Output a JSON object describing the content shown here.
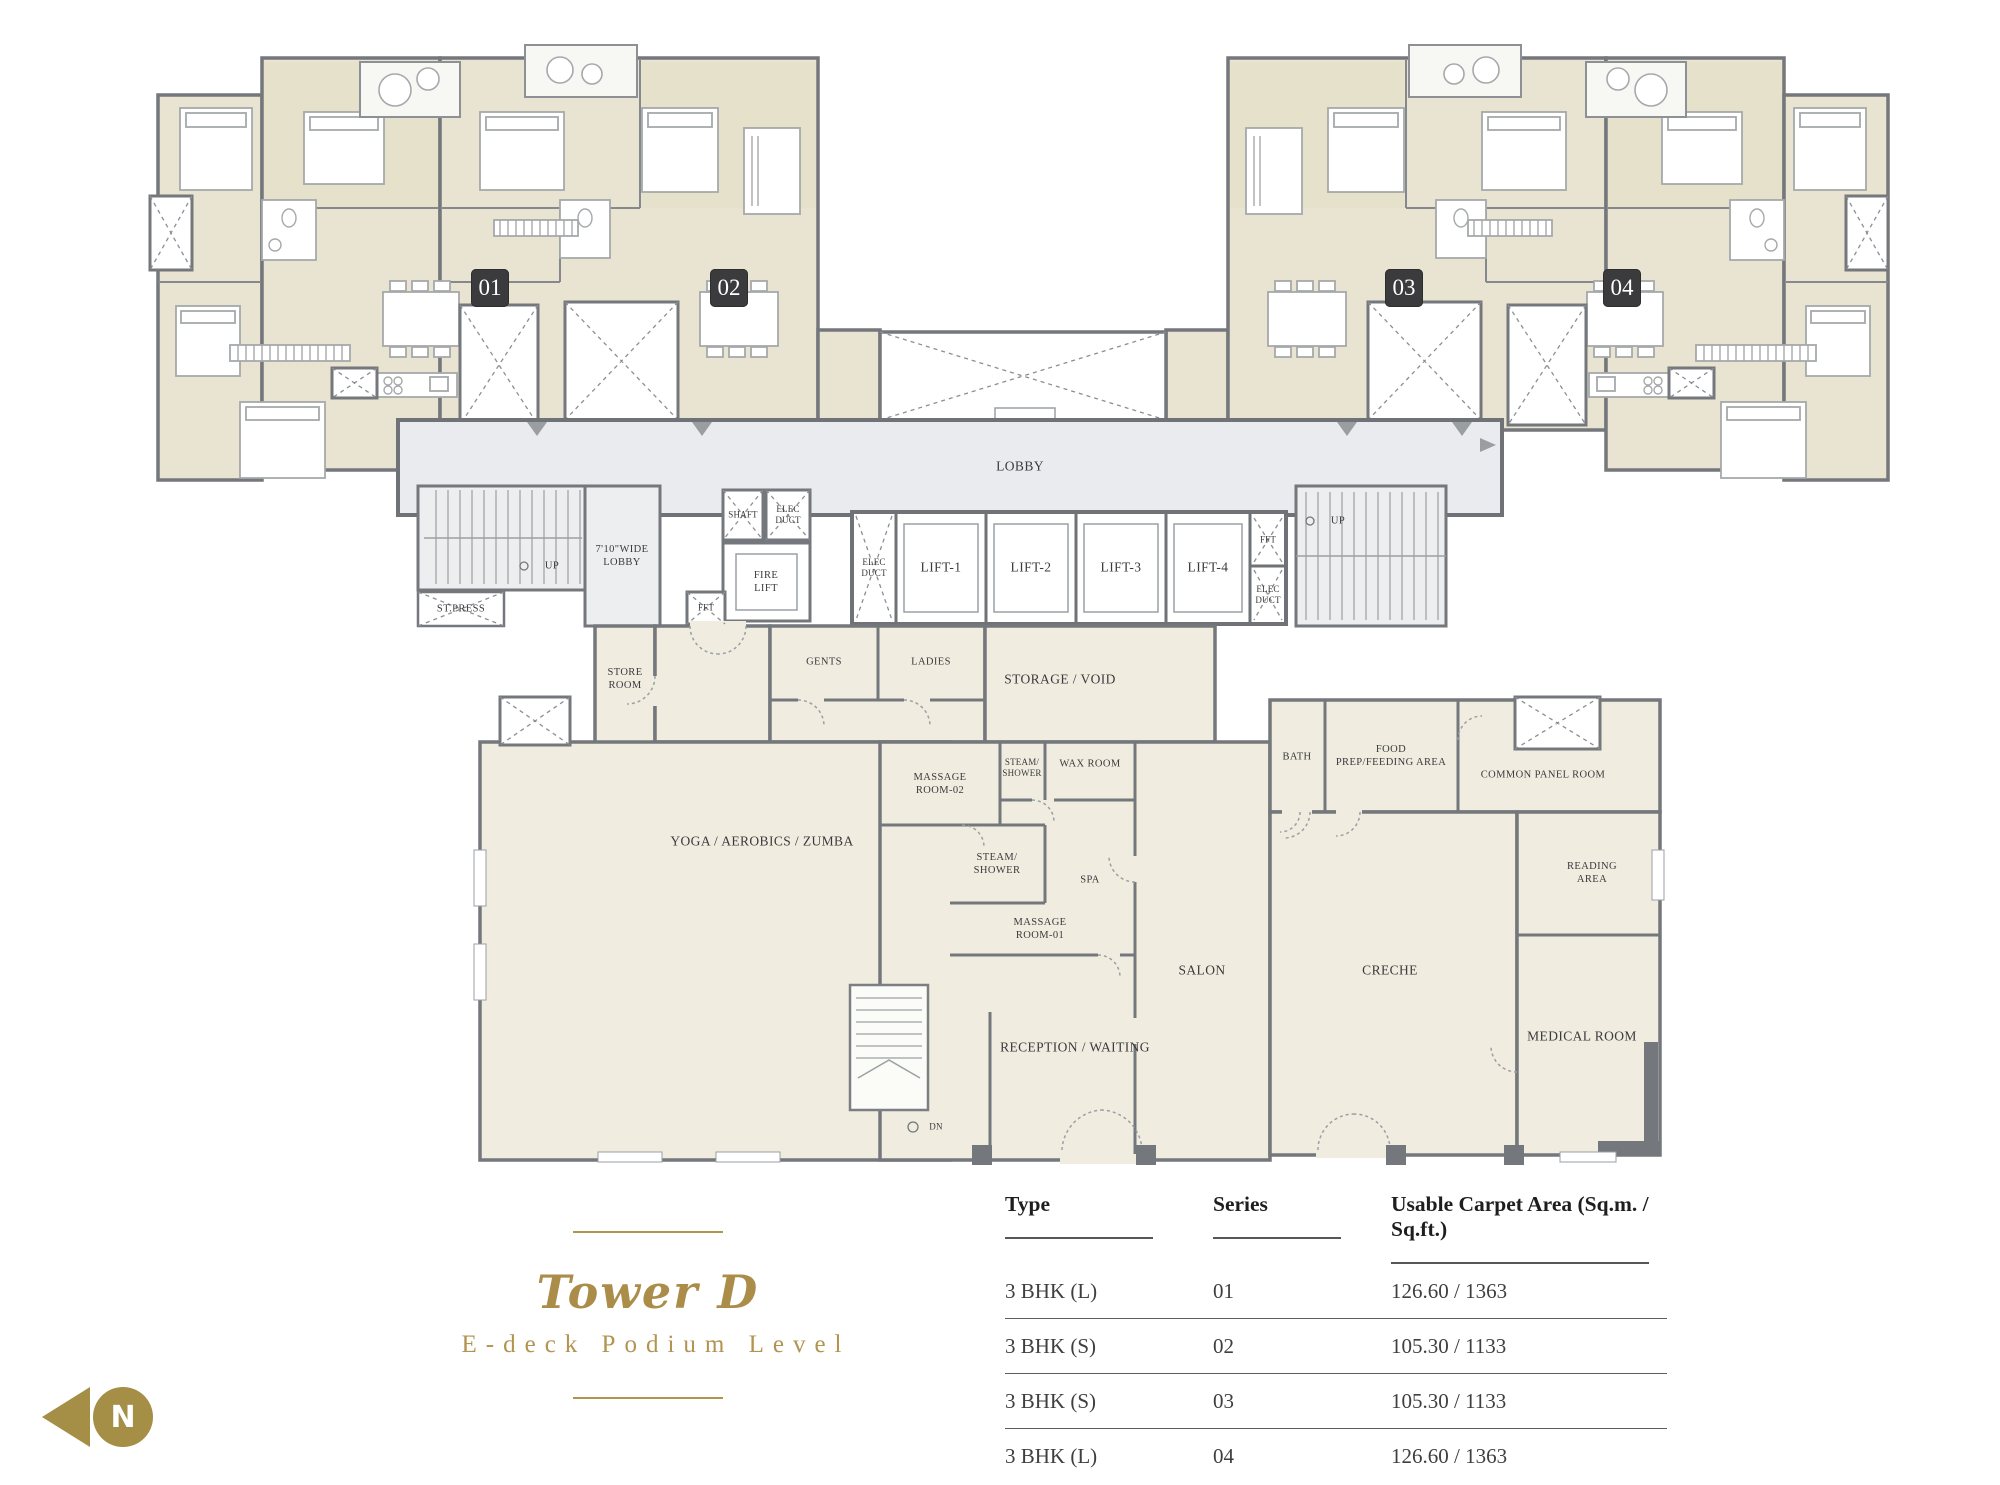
{
  "colors": {
    "accent_gold": "#ab8c49",
    "wall_gray": "#74777b",
    "apartment_fill": "#e9e4d1",
    "amenity_fill": "#f0ece0",
    "lobby_fill": "#e9ebee",
    "unit_badge_bg": "#3b3b3d"
  },
  "title": {
    "name": "Tower D",
    "subtitle": "E-deck Podium Level"
  },
  "north_label": "N",
  "units": [
    "01",
    "02",
    "03",
    "04"
  ],
  "core": {
    "lobby": "LOBBY",
    "up": "UP",
    "dn": "DN",
    "wide_lobby": {
      "l1": "7'10\"WIDE",
      "l2": "LOBBY"
    },
    "st_press": "ST.PRESS",
    "shaft": "SHAFT",
    "elec_duct": {
      "l1": "ELEC",
      "l2": "DUCT"
    },
    "fire_lift": {
      "l1": "FIRE",
      "l2": "LIFT"
    },
    "fft": "FFT",
    "lifts": [
      "LIFT-1",
      "LIFT-2",
      "LIFT-3",
      "LIFT-4"
    ]
  },
  "amenities": {
    "store_room": {
      "l1": "STORE",
      "l2": "ROOM"
    },
    "gents": "GENTS",
    "ladies": "LADIES",
    "storage_void": "STORAGE / VOID",
    "massage_room_02": {
      "l1": "MASSAGE",
      "l2": "ROOM-02"
    },
    "steam_shower": {
      "l1": "STEAM/",
      "l2": "SHOWER"
    },
    "wax_room": "WAX ROOM",
    "bath": "BATH",
    "food_prep": {
      "l1": "FOOD",
      "l2": "PREP/FEEDING AREA"
    },
    "common_panel_room": "COMMON PANEL ROOM",
    "reading_area": {
      "l1": "READING",
      "l2": "AREA"
    },
    "yoga": "YOGA / AEROBICS / ZUMBA",
    "spa": "SPA",
    "massage_room_01": {
      "l1": "MASSAGE",
      "l2": "ROOM-01"
    },
    "salon": "SALON",
    "creche": "CRECHE",
    "medical_room": "MEDICAL ROOM",
    "reception": "RECEPTION / WAITING"
  },
  "table": {
    "headers": [
      "Type",
      "Series",
      "Usable Carpet Area (Sq.m. / Sq.ft.)"
    ],
    "rows": [
      [
        "3 BHK (L)",
        "01",
        "126.60 / 1363"
      ],
      [
        "3 BHK (S)",
        "02",
        "105.30 / 1133"
      ],
      [
        "3 BHK (S)",
        "03",
        "105.30 / 1133"
      ],
      [
        "3 BHK (L)",
        "04",
        "126.60 / 1363"
      ]
    ]
  }
}
